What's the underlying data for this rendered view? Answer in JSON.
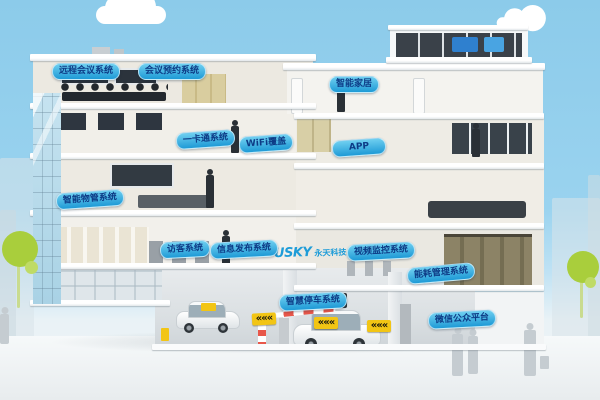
{
  "colors": {
    "sky": "#8CCBEA",
    "label_bg_top": "#6FCFF0",
    "label_bg_bottom": "#1E9AD6",
    "label_text": "#0D3B86",
    "logo_blue": "#1E9CD8",
    "tree_green": "#A9CE3C",
    "arrow_sign_yellow": "#F2C514",
    "barrier_red": "#E8574A"
  },
  "logo": {
    "text": "USKY",
    "suffix": "永天科技"
  },
  "icons": {
    "arrow_chevrons": "«««"
  },
  "labels": [
    {
      "id": "remote-conference-system",
      "text": "远程会议系统"
    },
    {
      "id": "meeting-booking-system",
      "text": "会议预约系统"
    },
    {
      "id": "smart-home",
      "text": "智能家居"
    },
    {
      "id": "one-card-system",
      "text": "一卡通系统"
    },
    {
      "id": "wifi-coverage",
      "text": "WiFi覆盖"
    },
    {
      "id": "app",
      "text": "APP"
    },
    {
      "id": "smart-property-management-system",
      "text": "智能物管系统"
    },
    {
      "id": "visitor-system",
      "text": "访客系统"
    },
    {
      "id": "information-publishing-system",
      "text": "信息发布系统"
    },
    {
      "id": "video-surveillance-system",
      "text": "视频监控系统"
    },
    {
      "id": "energy-management-system",
      "text": "能耗管理系统"
    },
    {
      "id": "smart-parking-system",
      "text": "智慧停车系统"
    },
    {
      "id": "wechat-public-platform",
      "text": "微信公众平台"
    }
  ]
}
